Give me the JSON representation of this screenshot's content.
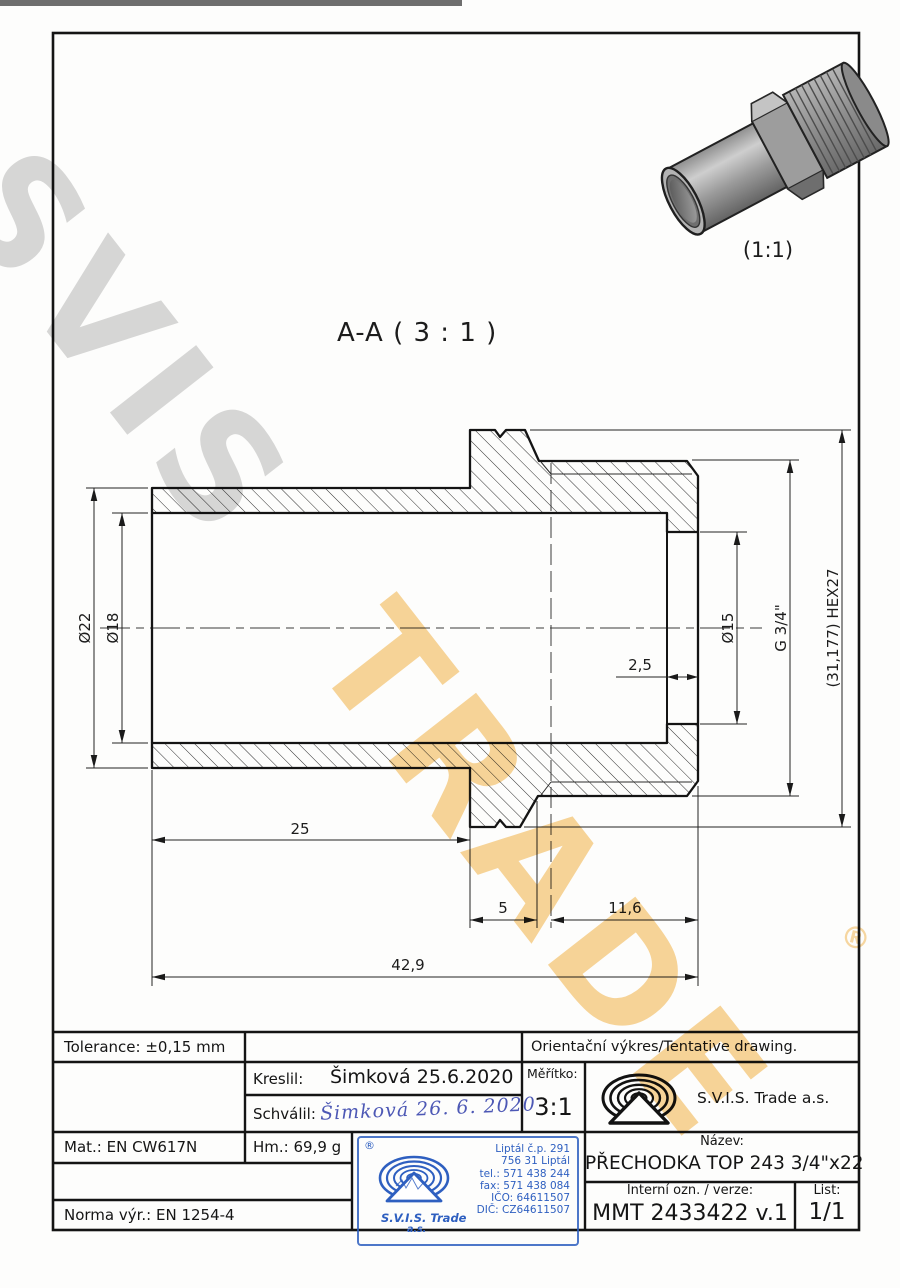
{
  "watermark": {
    "word1": "SVIS",
    "word2": "TRADE",
    "registered": "®",
    "gray": "rgba(125,125,125,0.30)",
    "orange": "rgba(242,178,70,0.55)"
  },
  "view3d": {
    "label": "(1:1)"
  },
  "section": {
    "label": "A-A ( 3 : 1 )"
  },
  "dims": {
    "dia22": "Ø22",
    "dia18": "Ø18",
    "dia15": "Ø15",
    "thread": "G 3/4\"",
    "hex": "(31,177) HEX27",
    "l25": "25",
    "l5": "5",
    "l116": "11,6",
    "l429": "42,9",
    "l25r": "2,5"
  },
  "titleblock": {
    "tolerance": "Tolerance: ±0,15 mm",
    "orientacni": "Orientační výkres/Tentative drawing.",
    "kreslil_label": "Kreslil:",
    "kreslil_value": "Šimková 25.6.2020",
    "schvalil_label": "Schválil:",
    "schvalil_value": "Šimková  26. 6. 2020",
    "meritko_label": "Měřítko:",
    "meritko_value": "3:1",
    "company": "S.V.I.S. Trade a.s.",
    "mat": "Mat.: EN CW617N",
    "hm": "Hm.: 69,9 g",
    "nazev_label": "Název:",
    "nazev_value": "PŘECHODKA TOP 243 3/4\"x22",
    "interni_label": "Interní ozn. / verze:",
    "interni_value": "MMT 2433422 v.1",
    "list_label": "List:",
    "list_value": "1/1",
    "norma": "Norma výr.: EN 1254-4"
  },
  "stamp": {
    "registered": "®",
    "company_line1": "S.V.I.S. Trade",
    "company_line2": "a.s.",
    "address": [
      "Liptál č.p. 291",
      "756 31 Liptál",
      "tel.: 571 438 244",
      "fax: 571 438 084",
      "IČO: 64611507",
      "DIČ: CZ64611507"
    ],
    "color": "#2e5fc0"
  }
}
